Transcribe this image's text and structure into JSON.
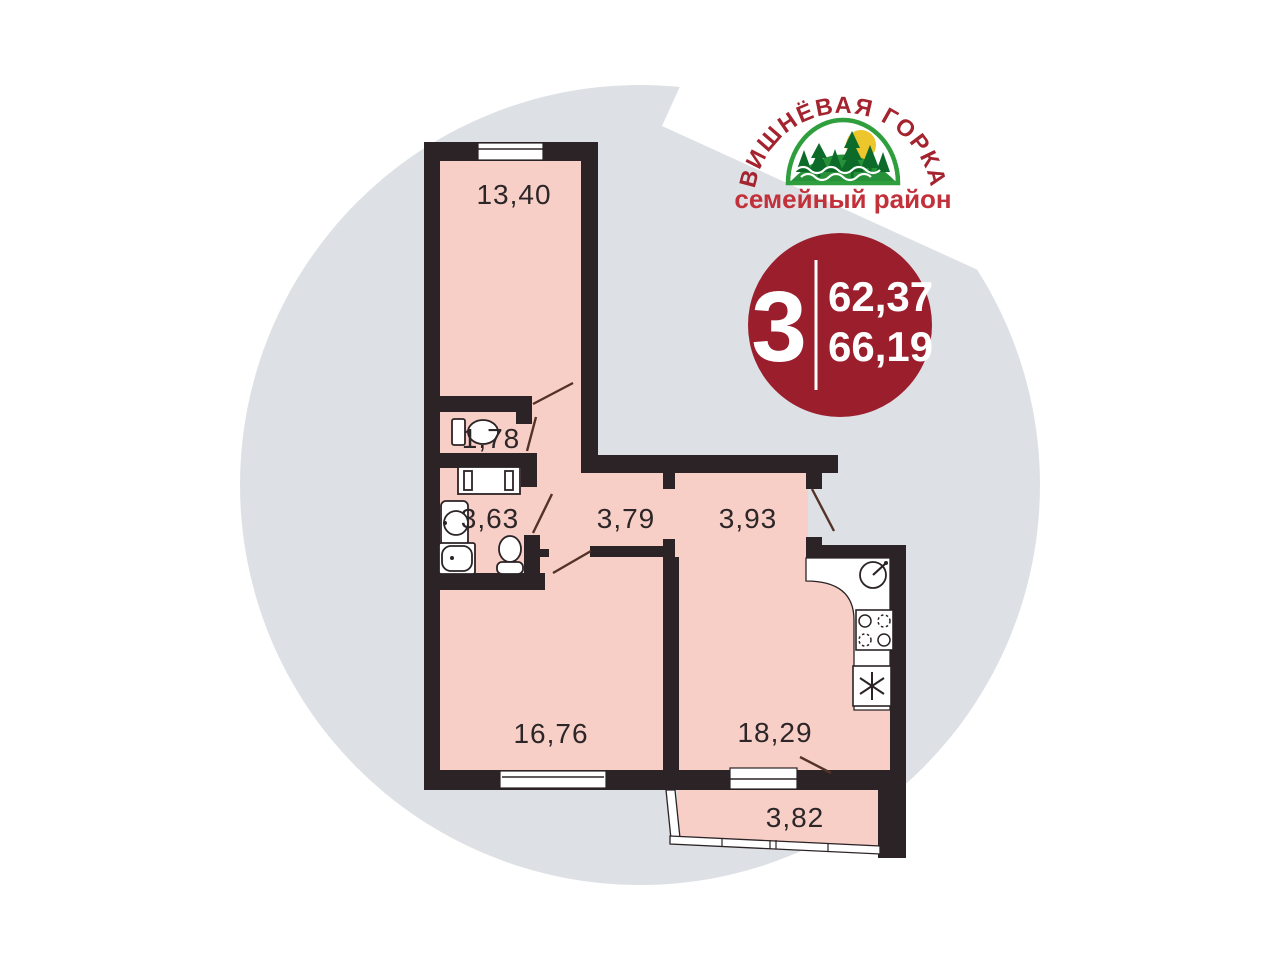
{
  "logo": {
    "arc_text": "ВИШНЁВАЯ ГОРКА",
    "subtitle": "семейный район"
  },
  "badge": {
    "rooms_count": "3",
    "area_line1": "62,37",
    "area_line2": "66,19"
  },
  "floor_plan": {
    "rooms": [
      {
        "name": "living-room-top",
        "area": "13,40"
      },
      {
        "name": "wc",
        "area": "1,78"
      },
      {
        "name": "bathroom",
        "area": "3,63"
      },
      {
        "name": "corridor",
        "area": "3,79"
      },
      {
        "name": "hall",
        "area": "3,93"
      },
      {
        "name": "bedroom",
        "area": "16,76"
      },
      {
        "name": "kitchen-living",
        "area": "18,29"
      },
      {
        "name": "balcony",
        "area": "3,82"
      }
    ],
    "fixtures": [
      "toilet",
      "washing-machine",
      "washbasin",
      "bathtub",
      "toilet",
      "kitchen-sink",
      "stove",
      "fridge"
    ]
  },
  "colors": {
    "room_fill": "#f7cfc6",
    "wall": "#2b2326",
    "background_circle": "#dde1e5",
    "badge": "#9b1e2d",
    "logo_red": "#a3242f",
    "logo_bright_red": "#c2303a",
    "logo_green": "#27913a",
    "logo_dark_green": "#0c6b28",
    "sun_yellow": "#edc62b",
    "door_swing": "#543227"
  }
}
